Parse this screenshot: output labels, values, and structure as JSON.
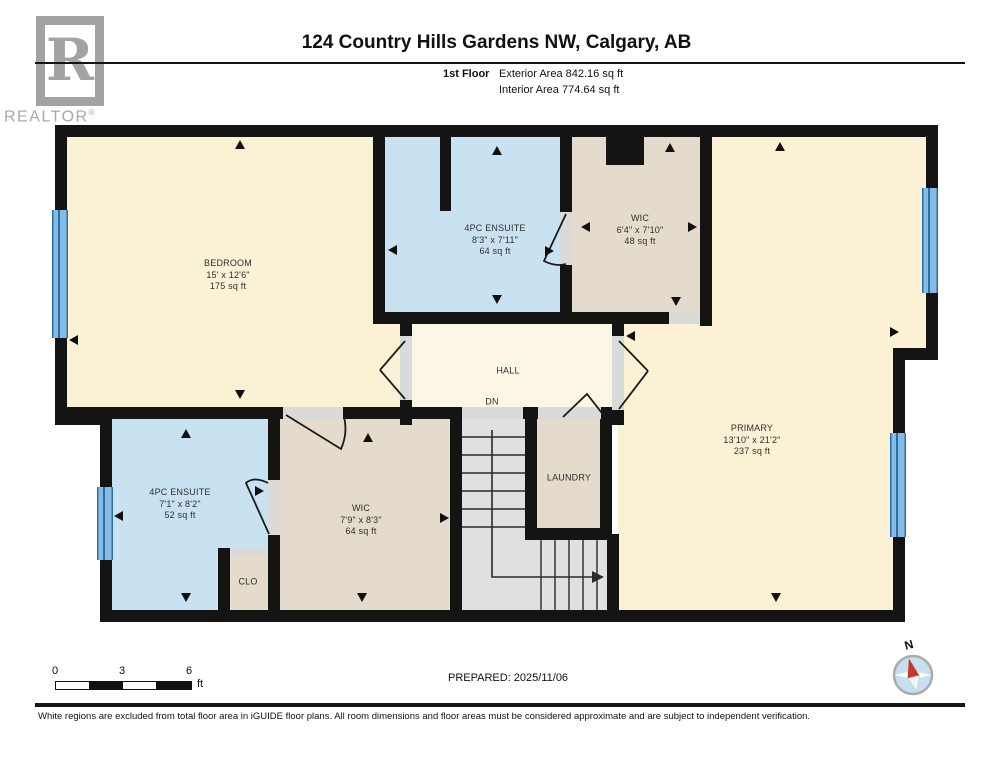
{
  "header": {
    "title": "124 Country Hills Gardens NW, Calgary, AB",
    "floor_label": "1st Floor",
    "exterior_area": "Exterior Area 842.16 sq ft",
    "interior_area": "Interior Area 774.64 sq ft"
  },
  "logo": {
    "letter": "R",
    "word": "REALTOR",
    "reg": "®"
  },
  "rooms": {
    "bedroom": {
      "name": "BEDROOM",
      "dims": "15' x 12'6\"",
      "area": "175 sq ft"
    },
    "ensuite_top": {
      "name": "4PC ENSUITE",
      "dims": "8'3\" x 7'11\"",
      "area": "64 sq ft"
    },
    "wic_top": {
      "name": "WIC",
      "dims": "6'4\" x 7'10\"",
      "area": "48 sq ft"
    },
    "primary": {
      "name": "PRIMARY",
      "dims": "13'10\" x 21'2\"",
      "area": "237 sq ft"
    },
    "hall": {
      "name": "HALL",
      "stairs_label": "DN"
    },
    "laundry": {
      "name": "LAUNDRY"
    },
    "ensuite_bottom": {
      "name": "4PC ENSUITE",
      "dims": "7'1\" x 8'2\"",
      "area": "52 sq ft"
    },
    "wic_bottom": {
      "name": "WIC",
      "dims": "7'9\" x 8'3\"",
      "area": "64 sq ft"
    },
    "closet": {
      "name": "CLO"
    }
  },
  "footer": {
    "scale_ticks": [
      "0",
      "3",
      "6"
    ],
    "scale_unit": "ft",
    "prepared": "PREPARED: 2025/11/06",
    "compass_label": "N",
    "disclaimer": "White regions are excluded from total floor area in iGUIDE floor plans. All room dimensions and floor areas must be considered approximate and are subject to independent verification."
  },
  "colors": {
    "room_cream": "#FBF2D5",
    "hall_cream": "#FCF6E4",
    "room_blue": "#C9E2F2",
    "room_tan": "#E4DBCC",
    "stairs_grey": "#E0E0E0",
    "wall": "#141414",
    "window_blue": "#85BCE5",
    "compass_red": "#C9342C",
    "logo_grey": "#A3A3A3"
  }
}
